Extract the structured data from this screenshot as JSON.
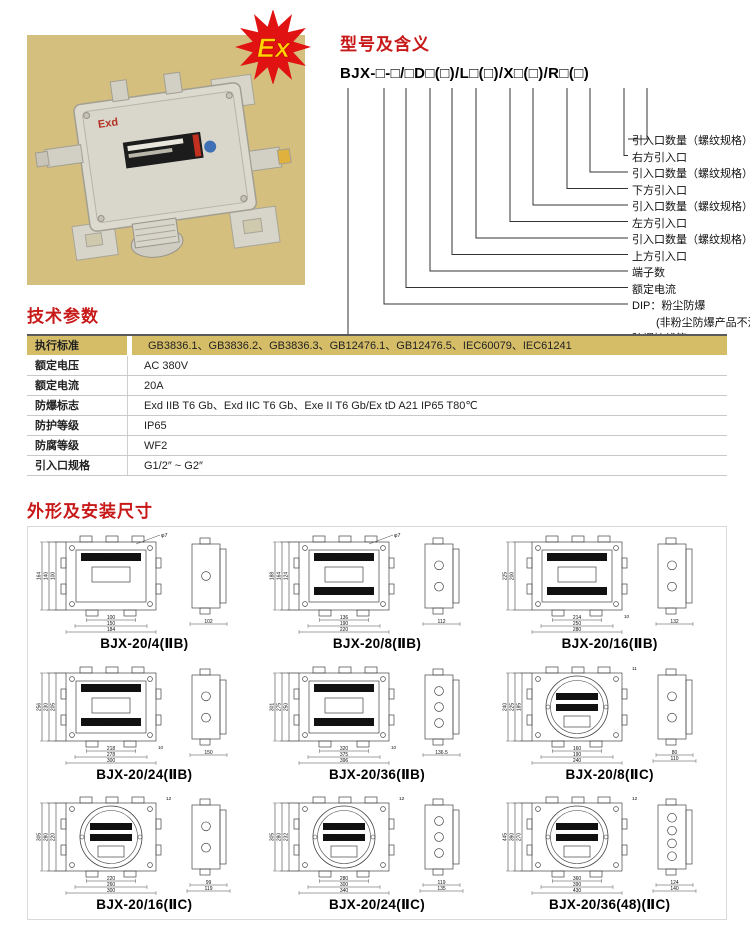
{
  "hero": {
    "badge": "Ex",
    "plate_text": "Exd",
    "photo_bg": "#d4bf7e",
    "badge_red": "#e01212",
    "badge_yellow": "#ffd400"
  },
  "model": {
    "title": "型号及含义",
    "code": "BJX-□-□/□D□(□)/L□(□)/X□(□)/R□(□)",
    "labels": [
      "引入口数量（螺纹规格）",
      "右方引入口",
      "引入口数量（螺纹规格）",
      "下方引入口",
      "引入口数量（螺纹规格）",
      "左方引入口",
      "引入口数量（螺纹规格）",
      "上方引入口",
      "端子数",
      "额定电流",
      "DIP：粉尘防爆",
      "(非粉尘防爆产品不注)",
      "防爆接线箱"
    ]
  },
  "params": {
    "title": "技术参数",
    "accent_color": "#d5bd68",
    "rows": [
      {
        "label": "执行标准",
        "value": "GB3836.1、GB3836.2、GB3836.3、GB12476.1、GB12476.5、IEC60079、IEC61241"
      },
      {
        "label": "额定电压",
        "value": "AC 380V"
      },
      {
        "label": "额定电流",
        "value": "20A"
      },
      {
        "label": "防爆标志",
        "value": "Exd IIB T6 Gb、Exd IIC T6 Gb、Exe II T6 Gb/Ex tD A21 IP65 T80℃"
      },
      {
        "label": "防护等级",
        "value": "IP65"
      },
      {
        "label": "防腐等级",
        "value": "WF2"
      },
      {
        "label": "引入口规格",
        "value": "G1/2″ ~ G2″"
      }
    ]
  },
  "dims": {
    "title": "外形及安装尺寸",
    "title_color": "#c81919",
    "drawings": [
      {
        "caption": "BJX-20/4(ⅡB)",
        "shape": "rect",
        "phi": "φ7",
        "tr": "",
        "v_dims": [
          "164",
          "140",
          "100"
        ],
        "h_dims": [
          "100",
          "150",
          "184"
        ],
        "h_extra": "",
        "side_dims": [
          "102"
        ],
        "side_holes": 1,
        "ex_label": "ExdⅡBT6",
        "warn": ""
      },
      {
        "caption": "BJX-20/8(ⅡB)",
        "shape": "rect",
        "phi": "φ7",
        "tr": "",
        "v_dims": [
          "188",
          "164",
          "124"
        ],
        "h_dims": [
          "136",
          "190",
          "220"
        ],
        "h_extra": "",
        "side_dims": [
          "112"
        ],
        "side_holes": 2,
        "ex_label": "ExdⅡBT6",
        "warn": "严禁带电开盖"
      },
      {
        "caption": "BJX-20/16(ⅡB)",
        "shape": "rect",
        "phi": "",
        "tr": "",
        "v_dims": [
          "225",
          "200"
        ],
        "h_dims": [
          "214",
          "250",
          "280"
        ],
        "h_extra": "10",
        "side_dims": [
          "132"
        ],
        "side_holes": 2,
        "ex_label": "ExdⅡBT6",
        "warn": "严禁带电开盖"
      },
      {
        "caption": "BJX-20/24(ⅡB)",
        "shape": "rect",
        "phi": "",
        "tr": "",
        "v_dims": [
          "256",
          "230",
          "205"
        ],
        "h_dims": [
          "218",
          "278",
          "300"
        ],
        "h_extra": "10",
        "side_dims": [
          "150"
        ],
        "side_holes": 2,
        "ex_label": "ExdⅡBT6",
        "warn": "严禁带电开盖"
      },
      {
        "caption": "BJX-20/36(ⅡB)",
        "shape": "rect",
        "phi": "",
        "tr": "",
        "v_dims": [
          "301",
          "275",
          "250"
        ],
        "h_dims": [
          "320",
          "375",
          "396"
        ],
        "h_extra": "10",
        "side_dims": [
          "136.5"
        ],
        "side_holes": 3,
        "ex_label": "ExdⅡBT6",
        "warn": "严禁带电开盖"
      },
      {
        "caption": "BJX-20/8(ⅡC)",
        "shape": "round",
        "phi": "",
        "tr": "11",
        "v_dims": [
          "240",
          "225",
          "185"
        ],
        "h_dims": [
          "160",
          "190",
          "240"
        ],
        "h_extra": "",
        "side_dims": [
          "80",
          "110"
        ],
        "side_holes": 2,
        "ex_label": "ExdⅡCT6",
        "warn": "严禁带电开盖"
      },
      {
        "caption": "BJX-20/16(ⅡC)",
        "shape": "round",
        "phi": "",
        "tr": "12",
        "v_dims": [
          "305",
          "280",
          "220"
        ],
        "h_dims": [
          "220",
          "260",
          "300"
        ],
        "h_extra": "",
        "side_dims": [
          "99",
          "119"
        ],
        "side_holes": 2,
        "ex_label": "ExdⅡCT6",
        "warn": "严禁带电开盖"
      },
      {
        "caption": "BJX-20/24(ⅡC)",
        "shape": "round",
        "phi": "",
        "tr": "12",
        "v_dims": [
          "305",
          "280",
          "232"
        ],
        "h_dims": [
          "280",
          "300",
          "340"
        ],
        "h_extra": "",
        "side_dims": [
          "119",
          "135"
        ],
        "side_holes": 3,
        "ex_label": "ExdⅡCT6",
        "warn": "严禁带电开盖"
      },
      {
        "caption": "BJX-20/36(48)(ⅡC)",
        "shape": "round",
        "phi": "",
        "tr": "12",
        "v_dims": [
          "445",
          "390",
          "270"
        ],
        "h_dims": [
          "360",
          "390",
          "430"
        ],
        "h_extra": "",
        "side_dims": [
          "124",
          "140"
        ],
        "side_holes": 4,
        "ex_label": "ExdⅡCT6",
        "warn": "严禁带电开盖"
      }
    ]
  }
}
